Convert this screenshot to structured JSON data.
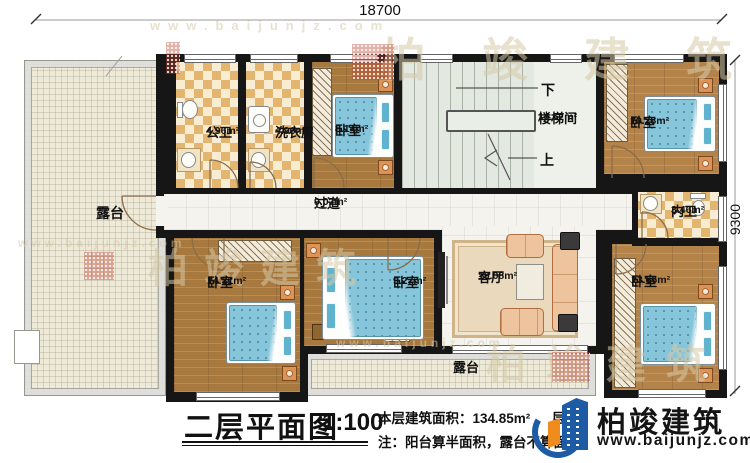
{
  "plan": {
    "dim_width": "18700",
    "dim_height": "9300",
    "stair_down": "下",
    "stair_up": "上",
    "rooms": {
      "gongwei": {
        "name": "公卫",
        "area": "4.96m²"
      },
      "xiyifang": {
        "name": "洗衣房",
        "area": "4.96m²"
      },
      "woshi_top": {
        "name": "卧室",
        "area": "8.14m²"
      },
      "loutijian": {
        "name": "楼梯间",
        "area": "14.57m²"
      },
      "woshi_ne": {
        "name": "卧室",
        "area": "10.28m²"
      },
      "neiwei": {
        "name": "内卫",
        "area": "3.46m²"
      },
      "guodao": {
        "name": "过道",
        "area": "9.07m²"
      },
      "woshi_sw": {
        "name": "卧室",
        "area": "14.31m²"
      },
      "woshi_s": {
        "name": "卧室",
        "area": "9.27m²"
      },
      "keting": {
        "name": "客厅",
        "area": "19.08m²"
      },
      "woshi_se": {
        "name": "卧室",
        "area": "13.66m²"
      },
      "terrace_left": {
        "name": "露台"
      },
      "terrace_bottom": {
        "name": "露台"
      }
    }
  },
  "footer": {
    "title": "二层平面图",
    "scale": "1:100",
    "area_text": "本层建筑面积：134.85m²",
    "height_text": "层高：",
    "note_text": "注：阳台算半面积，露台不算面积"
  },
  "brand": {
    "name": "柏竣建筑",
    "website": "www.baijunjz.com"
  },
  "watermark": {
    "text": "柏竣建筑",
    "website": "www.baijunjz.com"
  },
  "colors": {
    "wall": "#161616",
    "wood": "#a8793f",
    "wood_light": "#b3834a",
    "tile_dark": "#e4b56e",
    "tile_light": "#f8edd3",
    "terrace": "#eeead9",
    "stair": "#e3e8e0",
    "bed_blue": "#87c6da",
    "logo_blue": "#1d5ca5",
    "logo_orange": "#f08c1e"
  }
}
